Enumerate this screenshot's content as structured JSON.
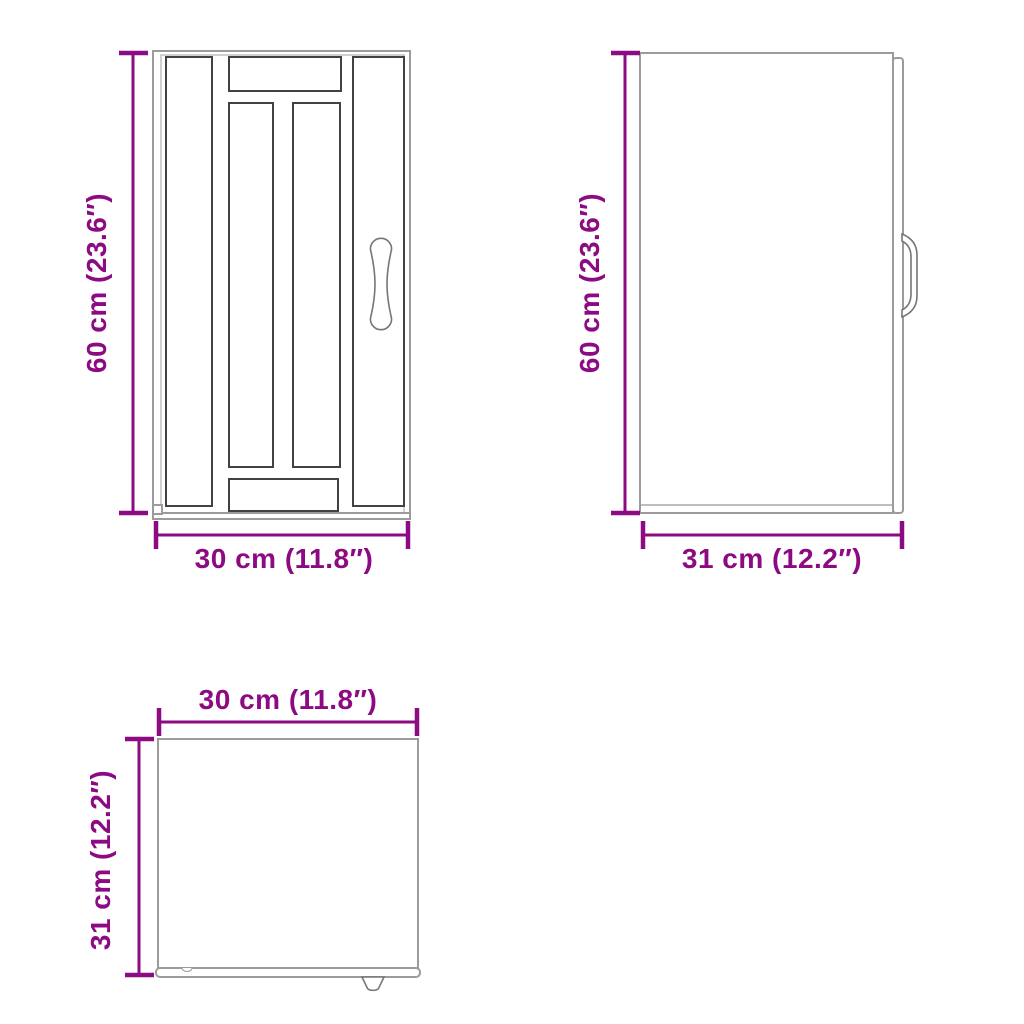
{
  "accent_color": "#8C0A82",
  "views": {
    "front": {
      "height_label": "60 cm (23.6″)",
      "width_label": "30 cm (11.8″)"
    },
    "side": {
      "height_label": "60 cm (23.6″)",
      "depth_label": "31 cm (12.2″)"
    },
    "top": {
      "width_label": "30 cm (11.8″)",
      "depth_label": "31 cm (12.2″)"
    }
  }
}
